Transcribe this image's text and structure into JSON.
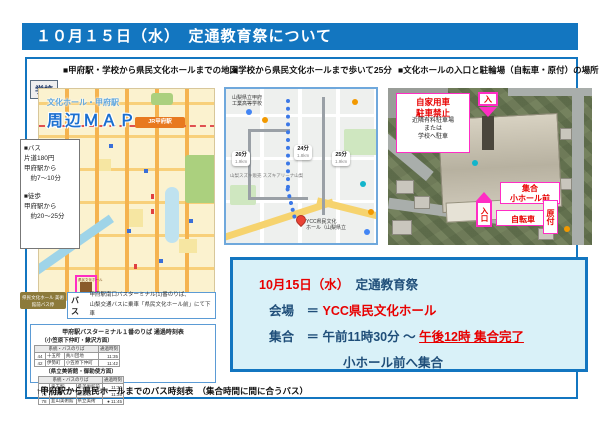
{
  "page": {
    "title": "１０月１５日（水）　定通教育祭について"
  },
  "section_headers": {
    "left": "■甲府駅・学校から県民文化ホールまでの地図",
    "middle": "■学校から県民文化ホールまで歩いて25分",
    "right": "■文化ホールの入口と駐輪場（自転車・原付）の場所"
  },
  "street_map": {
    "school_chip": "学校",
    "title_line1": "文化ホール・甲府駅",
    "title_line2": "周辺ＭＡＰ",
    "station_label": "JR甲府駅",
    "hall_tag": "県民文化ホール",
    "busstop_label": "県民文化ホール 美術館前バス停",
    "info_lines": [
      "■バス",
      "片道180円",
      "甲府駅から",
      "　約7～10分",
      "",
      "■徒歩",
      "甲府駅から",
      "　約20～25分"
    ],
    "bus_callout": {
      "tag": "バス",
      "line1": "甲府駅南口バスターミナル(1)番のりば、",
      "line2": "山梨交通バスに乗車「県民文化ホール前」にて下車"
    },
    "timetable": {
      "title": "甲府駅バスターミナル１番のりば 通過時刻表",
      "left_group": {
        "name": "（小笠原下仲町・鰍沢方面）",
        "col1": "系統・バスのりば",
        "col2": "通過時刻",
        "rows": [
          [
            "44",
            "十五所",
            "貢川団地",
            "11:35"
          ],
          [
            "42",
            "伊勢町",
            "小笠原下仲町",
            "11:42"
          ]
        ]
      },
      "right_group": {
        "name": "（県立美術館・御勅使方面）",
        "col1": "系統・バスのりば",
        "col2": "通過時刻",
        "rows": [
          [
            "50",
            "竜王駅",
            "県美術館前",
            "11:30"
          ],
          [
            "76",
            "大草",
            "敷島営",
            "11:35"
          ],
          [
            "78",
            "韮山美術館",
            "県立美術",
            "● 11:45"
          ]
        ]
      }
    },
    "caption": "↑甲府駅から県民ホールまでのバス時刻表　（集合時間に間に合うバス）"
  },
  "walk_map": {
    "school_line1": "山梨県立甲府",
    "school_line2": "工業高等学校",
    "bubbles": [
      {
        "time": "26分",
        "dist": "1.9km"
      },
      {
        "time": "24分",
        "dist": "1.8km"
      },
      {
        "time": "25分",
        "dist": "1.9km"
      }
    ],
    "landmark": "山梨スズキ販売 スズキアリーナ山梨",
    "dest_line1": "YCC県民文化",
    "dest_line2": "ホール（山梨県立"
  },
  "aerial": {
    "no_parking_red1": "自家用車",
    "no_parking_red2": "駐車禁止",
    "no_parking_black1": "近隣有料駐車場",
    "no_parking_black2": "または",
    "no_parking_black3": "学校へ駐車",
    "enter_top": "入",
    "gather_line1": "集合",
    "gather_line2": "小ホール前",
    "entrance": "入口",
    "bicycle": "自転車",
    "moped": "原付"
  },
  "info_box": {
    "date_red": "10月15日（水）",
    "event_blue": "　定通教育祭",
    "venue_label": "会場　＝ ",
    "venue_value": "YCC県民文化ホール",
    "meet_label": "集合　＝ ",
    "meet_time_blue": "午前11時30分 ～ ",
    "meet_time_red": "午後12時 集合完了",
    "meet_place": "小ホール前へ集合"
  }
}
